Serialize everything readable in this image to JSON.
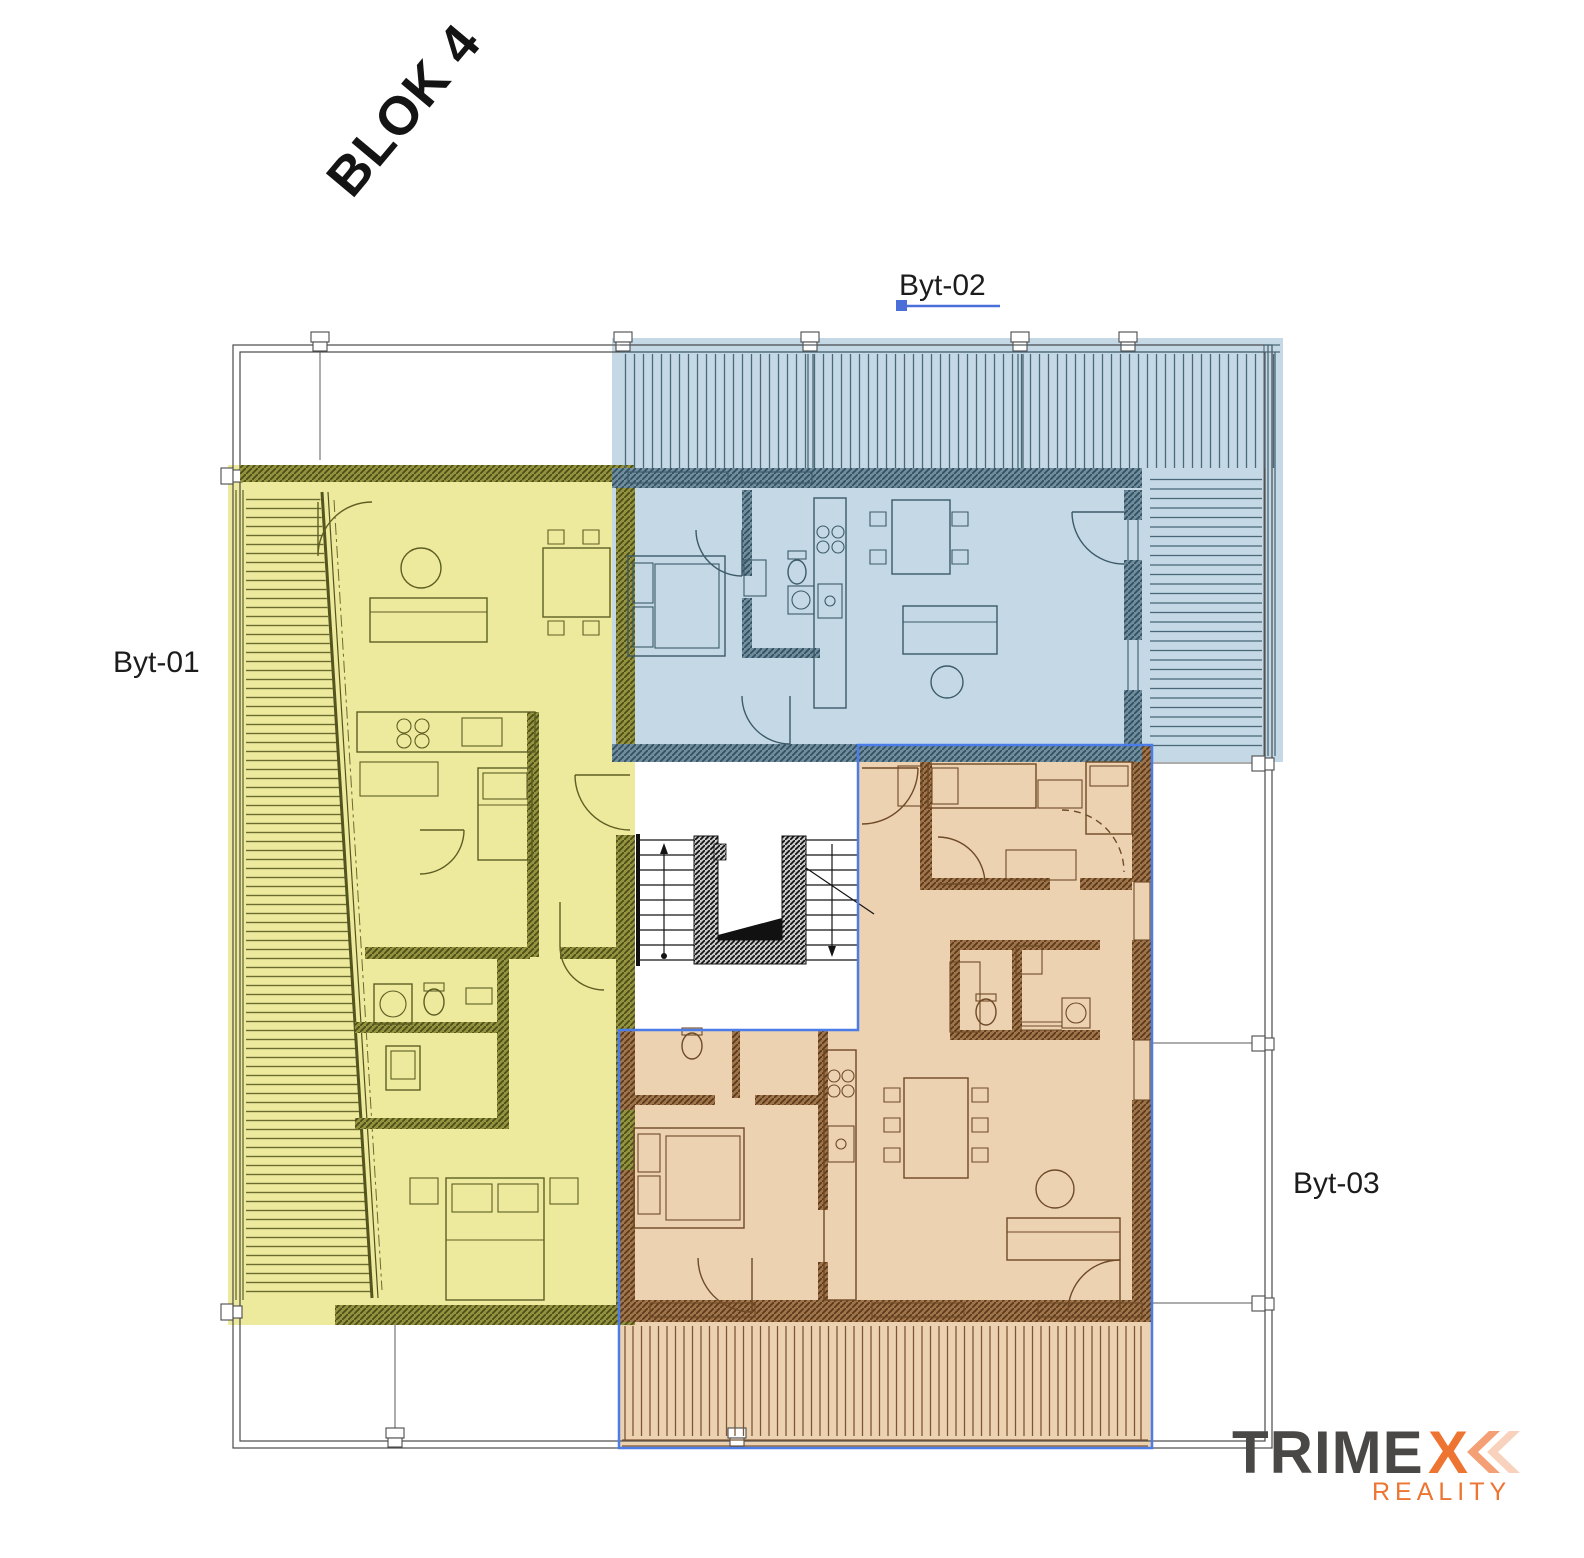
{
  "scene": {
    "block_title": "BLOK 4"
  },
  "apartments": [
    {
      "id": "byt-01",
      "label": "Byt-01",
      "fill": "#edea9d",
      "wall_color": "#4d4d18"
    },
    {
      "id": "byt-02",
      "label": "Byt-02",
      "fill": "#c4d9e5",
      "wall_color": "#32505f",
      "underline_color": "#4a6fd8"
    },
    {
      "id": "byt-03",
      "label": "Byt-03",
      "fill": "#edd2b2",
      "wall_color": "#5a3a1b",
      "selection_color": "#4a7de8"
    }
  ],
  "logo": {
    "word_main": "TRIME",
    "word_accent": "X",
    "tagline": "REALITY",
    "color_main": "#4a4846",
    "color_accent": "#ed7431",
    "chevron1_color": "#f3a077",
    "chevron2_color": "#f8d2bc"
  }
}
